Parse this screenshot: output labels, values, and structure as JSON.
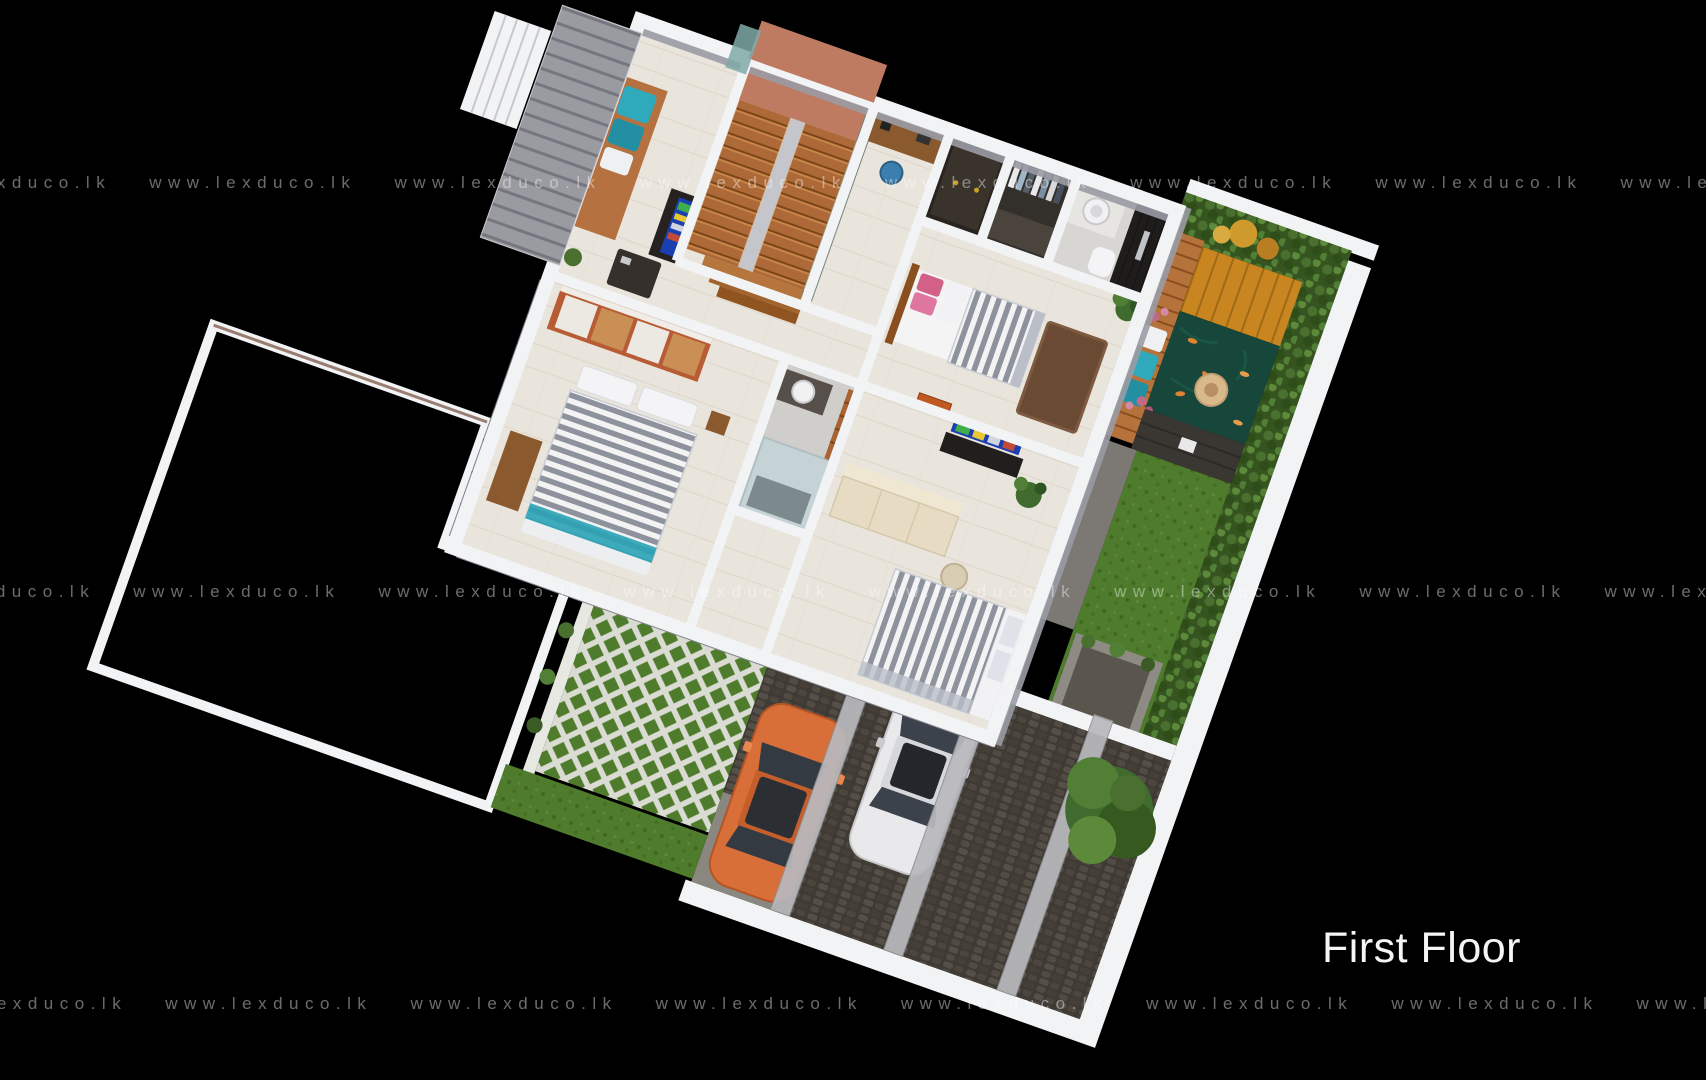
{
  "title": {
    "label": "First Floor"
  },
  "watermark": {
    "text": "www.lexduco.lk",
    "row_count": 3,
    "units_per_row": 9
  },
  "scene": {
    "type": "3d-floor-plan-render",
    "view": "aerial-isometric",
    "floor_shown": "First Floor",
    "elements": [
      "staircase-wood-u-shaped",
      "stair-landing-terracotta",
      "family-lounge",
      "window-seat-teal-cushions",
      "lounge-tv-screen",
      "lounge-tv-console",
      "coffee-table",
      "study-desk",
      "blue-office-chair",
      "dark-cabinet",
      "walk-in-closet",
      "clothes-rail",
      "ensuite-bathroom",
      "round-wash-basin",
      "toilet",
      "dark-mosaic-shower-wall",
      "master-bedroom",
      "master-bed-gray-striped",
      "pink-pillows",
      "area-rug",
      "potted-plant",
      "wall-art-orange",
      "bedroom-2",
      "sliding-wardrobe-orange-frame",
      "bed-2-gray-striped",
      "dresser",
      "window-mullion-band",
      "bathroom-2",
      "glass-shower-cubicle",
      "bedroom-3",
      "cream-sofa",
      "round-side-table",
      "bed-3-gray-striped",
      "tv-screen-colorful",
      "tv-console",
      "palm-plant",
      "balcony-garden",
      "wood-deck-amber",
      "deck-walkway",
      "bench-teal-cushions",
      "koi-pond",
      "koi-fish",
      "stone-fountain",
      "pink-bougainvillea",
      "garden-hedge",
      "orange-foliage",
      "stone-feature-wall",
      "garden-lamp",
      "stone-path",
      "lawn",
      "creeper-wall",
      "stone-planter",
      "louver-sunshade",
      "mini-terrace",
      "tiled-roof-brown",
      "grass-paver-courtyard",
      "shrub-border-purple-flowers",
      "carport-cobblestone",
      "white-car",
      "orange-car",
      "pergola-beams",
      "garden-tree",
      "boundary-wall",
      "concrete-apron"
    ]
  },
  "colors": {
    "bg": "#000000",
    "wall": "#f2f3f5",
    "wall_shadow": "#9a9ba4",
    "wall_edge": "#b8b9c1",
    "floor": "#e9e4dc",
    "floor_line": "#ddd5c8",
    "wood": "#b5713f",
    "wood_dark": "#7c4517",
    "terracotta": "#bf7a62",
    "sage": "#74837c",
    "roof": "#8a6e62",
    "roof_line": "#6f564c",
    "lawn": "#4f7c2c",
    "hedge": "#35541f",
    "foliage_orange": "#cf9a2d",
    "pond": "#17463a",
    "koi": "#e0822f",
    "deck": "#c9851f",
    "deck_walk": "#b5723a",
    "stone_wall": "#3a3733",
    "cobble": "#3f3a34",
    "beam": "#b9b9bd",
    "car_white": "#e9e9ec",
    "car_orange": "#d96f38",
    "teal": "#2fa9bc",
    "pink": "#d26087",
    "bed_stripe": "#8d929c",
    "tv_screen": "#1a3fb0",
    "art": "#c05a20",
    "watermark": "rgba(255,255,255,0.42)",
    "title": "#f5f5f5"
  }
}
